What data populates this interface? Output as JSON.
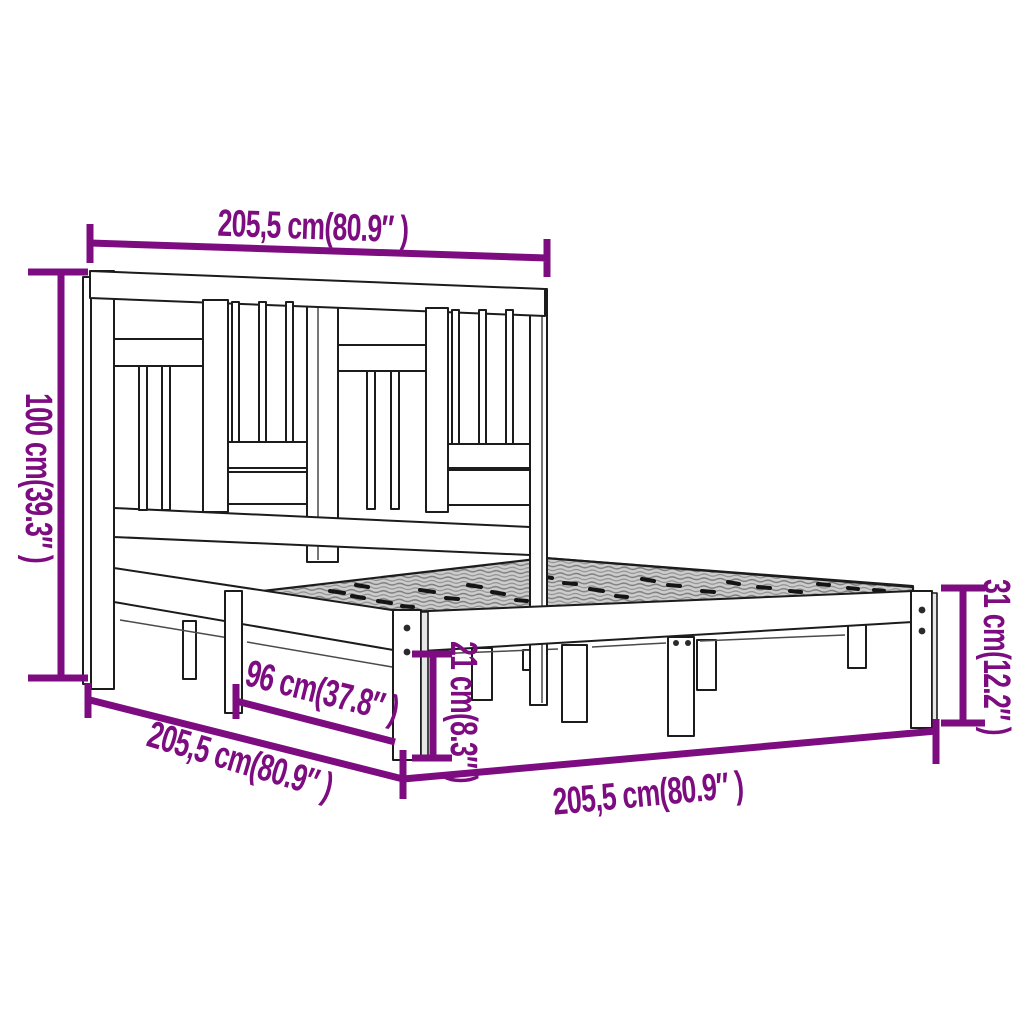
{
  "figure": {
    "alt": "Line drawing of a wooden bed frame with panelled headboard and slatted base, annotated with dimension lines"
  },
  "colors": {
    "dimension": "#7c0c80",
    "outline": "#1c1c1c",
    "slat_fill": "#cdcdcd",
    "background": "#ffffff"
  },
  "dimensions": {
    "headboard_width_top": "205,5 cm(80.9″ )",
    "headboard_height_left": "100 cm(39.3″ )",
    "base_height_right": "31 cm(12.2″ )",
    "underbed_clearance_middle": "21 cm(8.3″ )",
    "partial_width_diagonal": "96 cm(37.8″ )",
    "frame_width_diagonal": "205,5 cm(80.9″ )",
    "frame_length_bottom": "205,5 cm(80.9″ )"
  }
}
